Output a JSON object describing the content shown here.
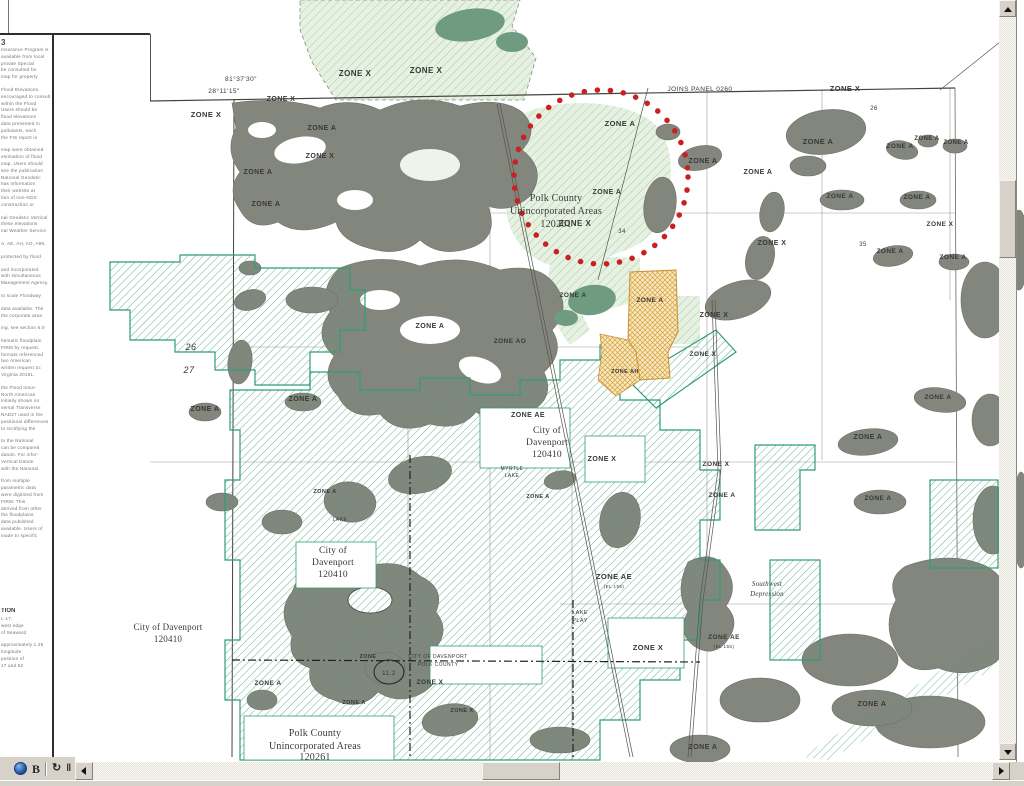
{
  "colors": {
    "map_gray": "#83867c",
    "map_gray_right": "#8b8e85",
    "hatch_green": "#3f9e78",
    "city_boundary_green": "#2f9e77",
    "light_green_fill": "#e2eedd",
    "light_hatch": "#9cc8a0",
    "dark_green_blob": "#6f9c80",
    "red_annotation": "#c92121",
    "orange_zone_line": "#d8a03a",
    "orange_zone_fill": "#f6e8c2",
    "chrome_gray": "#d6d2ca"
  },
  "toolbar": {
    "icons": [
      {
        "name": "globe-icon",
        "glyph": ""
      },
      {
        "name": "letter-b-icon",
        "glyph": "B"
      },
      {
        "name": "refresh-icon",
        "glyph": "↻"
      },
      {
        "name": "pause-icon",
        "glyph": "‖"
      }
    ]
  },
  "notes_panel": {
    "heading": "3",
    "lines": [
      "Insurance Program is",
      "available from local",
      "private Special",
      "be consulted for",
      "map for property",
      "",
      "Flood Elevations.",
      "encouraged to consult",
      "within the Flood",
      "Users should be",
      "flood elevations",
      "data presented in",
      "pollutants, each",
      "the FIS report in",
      "",
      "map were obtained",
      "estimation of flood",
      "map. Users should",
      "see the publication",
      "National Geodetic",
      "has information",
      "their website at",
      "tion of non-NGS",
      "construction or",
      "",
      "nal Geodetic Vertical",
      "these elevations",
      "nal Weather Service",
      "",
      "A, AE, AH, AO, A99,",
      "",
      "protected by flood",
      "",
      "and incorporated",
      "with simultaneous",
      "Management Agency.",
      "",
      "to scale Floodway",
      "",
      "data available. The",
      "the corporate area",
      "",
      "ing, see section 6.0",
      "",
      "hematic floodplain",
      "FIRM by request.",
      "formats referenced",
      "two American",
      "written request to:",
      "Virginia 20191.",
      "",
      "the Flood Insur-",
      "North American",
      "initially shown on",
      "versal Transverse",
      "NAD27 used in the",
      "positional differences",
      "to rectifying the",
      "",
      "to the National",
      "can be compared",
      "datum. For infor-",
      "Vertical Datum",
      "with the National",
      "",
      "from multiple",
      "parametric data",
      "were digitized from",
      "FIRM. This",
      "derived from other",
      "the floodplains",
      "data published",
      "available. Users of",
      "made to specific"
    ],
    "section2_heading": "TION",
    "section2_lines": [
      "L-17,",
      "west edge",
      "of Seaward",
      "",
      "approximately 1.29",
      "longitude",
      "position of",
      "17 and 52"
    ]
  },
  "map": {
    "labels": [
      {
        "t": "81°37'30\"",
        "x": 241,
        "y": 81,
        "s": 6.5,
        "c": "#4a4a46"
      },
      {
        "t": "28°11'15\"",
        "x": 224,
        "y": 93,
        "s": 6.5,
        "c": "#4a4a46"
      },
      {
        "t": "ZONE X",
        "x": 206,
        "y": 117,
        "s": 7.5,
        "b": 1
      },
      {
        "t": "ZONE X",
        "x": 281,
        "y": 101,
        "s": 7,
        "b": 1
      },
      {
        "t": "ZONE X",
        "x": 355,
        "y": 76,
        "s": 8,
        "b": 1
      },
      {
        "t": "ZONE X",
        "x": 426,
        "y": 73,
        "s": 8,
        "b": 1
      },
      {
        "t": "ZONE A",
        "x": 322,
        "y": 130,
        "s": 7,
        "b": 1
      },
      {
        "t": "ZONE X",
        "x": 320,
        "y": 158,
        "s": 7,
        "b": 1
      },
      {
        "t": "ZONE A",
        "x": 258,
        "y": 174,
        "s": 7,
        "b": 1
      },
      {
        "t": "ZONE A",
        "x": 266,
        "y": 206,
        "s": 7,
        "b": 1
      },
      {
        "t": "JOINS PANEL 0260",
        "x": 700,
        "y": 91,
        "s": 6.5,
        "c": "#4a4a46"
      },
      {
        "t": "ZONE X",
        "x": 845,
        "y": 91,
        "s": 7.5,
        "b": 1
      },
      {
        "t": "26",
        "x": 874,
        "y": 110,
        "s": 6
      },
      {
        "t": "ZONE A",
        "x": 620,
        "y": 126,
        "s": 7.5,
        "b": 1
      },
      {
        "t": "ZONE A",
        "x": 607,
        "y": 194,
        "s": 7,
        "b": 1
      },
      {
        "t": "ZONE X",
        "x": 575,
        "y": 226,
        "s": 8,
        "b": 1
      },
      {
        "t": "Polk County",
        "x": 556,
        "y": 201,
        "s": 10,
        "f": "serif"
      },
      {
        "t": "Unincorporated Areas",
        "x": 556,
        "y": 214,
        "s": 10,
        "f": "serif"
      },
      {
        "t": "120261",
        "x": 556,
        "y": 227,
        "s": 10,
        "f": "serif"
      },
      {
        "t": "34",
        "x": 622,
        "y": 233,
        "s": 6
      },
      {
        "t": "ZONE A",
        "x": 703,
        "y": 163,
        "s": 7,
        "b": 1
      },
      {
        "t": "ZONE A",
        "x": 758,
        "y": 174,
        "s": 7,
        "b": 1
      },
      {
        "t": "ZONE A",
        "x": 818,
        "y": 144,
        "s": 7.5,
        "b": 1
      },
      {
        "t": "ZONE A",
        "x": 900,
        "y": 148,
        "s": 6.5,
        "b": 1
      },
      {
        "t": "ZONE A",
        "x": 927,
        "y": 140,
        "s": 6,
        "b": 1
      },
      {
        "t": "ZONE A",
        "x": 956,
        "y": 144,
        "s": 6,
        "b": 1
      },
      {
        "t": "ZONE A",
        "x": 840,
        "y": 198,
        "s": 6.5,
        "b": 1
      },
      {
        "t": "ZONE A",
        "x": 917,
        "y": 199,
        "s": 6.5,
        "b": 1
      },
      {
        "t": "ZONE X",
        "x": 940,
        "y": 226,
        "s": 6.5,
        "b": 1
      },
      {
        "t": "35",
        "x": 863,
        "y": 246,
        "s": 6
      },
      {
        "t": "ZONE A",
        "x": 890,
        "y": 253,
        "s": 6.5,
        "b": 1
      },
      {
        "t": "ZONE A",
        "x": 953,
        "y": 259,
        "s": 6.5,
        "b": 1
      },
      {
        "t": "ZONE X",
        "x": 772,
        "y": 245,
        "s": 7,
        "b": 1
      },
      {
        "t": "ZONE A",
        "x": 573,
        "y": 297,
        "s": 6.5,
        "b": 1
      },
      {
        "t": "ZONE A",
        "x": 650,
        "y": 302,
        "s": 6.5,
        "b": 1
      },
      {
        "t": "ZONE X",
        "x": 714,
        "y": 317,
        "s": 7,
        "b": 1
      },
      {
        "t": "ZONE X",
        "x": 703,
        "y": 356,
        "s": 6.5,
        "b": 1
      },
      {
        "t": "ZONE AH",
        "x": 625,
        "y": 373,
        "s": 5.5,
        "b": 1
      },
      {
        "t": "ZONE A",
        "x": 430,
        "y": 328,
        "s": 7,
        "b": 1
      },
      {
        "t": "ZONE AO",
        "x": 510,
        "y": 343,
        "s": 6.5,
        "b": 1
      },
      {
        "t": "26",
        "x": 191,
        "y": 350,
        "s": 9,
        "i": 1,
        "c": "#8a887e"
      },
      {
        "t": "27",
        "x": 189,
        "y": 373,
        "s": 9,
        "i": 1,
        "c": "#8a887e"
      },
      {
        "t": "ZONE A",
        "x": 205,
        "y": 411,
        "s": 7,
        "b": 1
      },
      {
        "t": "ZONE A",
        "x": 303,
        "y": 401,
        "s": 7,
        "b": 1
      },
      {
        "t": "ZONE AE",
        "x": 528,
        "y": 417,
        "s": 7,
        "b": 1
      },
      {
        "t": "City of",
        "x": 547,
        "y": 433,
        "s": 9.5,
        "f": "serif"
      },
      {
        "t": "Davenport",
        "x": 547,
        "y": 445,
        "s": 9.5,
        "f": "serif"
      },
      {
        "t": "120410",
        "x": 547,
        "y": 457,
        "s": 9.5,
        "f": "serif"
      },
      {
        "t": "ZONE X",
        "x": 602,
        "y": 461,
        "s": 7,
        "b": 1
      },
      {
        "t": "MYRTLE",
        "x": 512,
        "y": 470,
        "s": 5
      },
      {
        "t": "LAKE",
        "x": 512,
        "y": 477,
        "s": 5
      },
      {
        "t": "ZONE A",
        "x": 538,
        "y": 498,
        "s": 5.5,
        "b": 1
      },
      {
        "t": "ZONE X",
        "x": 716,
        "y": 466,
        "s": 6.5,
        "b": 1
      },
      {
        "t": "ZONE A",
        "x": 722,
        "y": 497,
        "s": 6.5,
        "b": 1
      },
      {
        "t": "ZONE A",
        "x": 868,
        "y": 439,
        "s": 7,
        "b": 1
      },
      {
        "t": "ZONE A",
        "x": 878,
        "y": 500,
        "s": 6.5,
        "b": 1
      },
      {
        "t": "ZONE A",
        "x": 938,
        "y": 399,
        "s": 6.5,
        "b": 1
      },
      {
        "t": "ZONE A",
        "x": 325,
        "y": 493,
        "s": 5.5,
        "b": 1
      },
      {
        "t": "LAKE",
        "x": 340,
        "y": 521,
        "s": 5
      },
      {
        "t": "City of",
        "x": 333,
        "y": 553,
        "s": 9.5,
        "f": "serif"
      },
      {
        "t": "Davenport",
        "x": 333,
        "y": 565,
        "s": 9.5,
        "f": "serif"
      },
      {
        "t": "120410",
        "x": 333,
        "y": 577,
        "s": 9.5,
        "f": "serif"
      },
      {
        "t": "ZONE AE",
        "x": 614,
        "y": 579,
        "s": 7.5,
        "b": 1
      },
      {
        "t": "(EL 159)",
        "x": 614,
        "y": 588,
        "s": 4.5
      },
      {
        "t": "LAKE",
        "x": 580,
        "y": 614,
        "s": 5.5
      },
      {
        "t": "PLAY",
        "x": 580,
        "y": 622,
        "s": 5.5
      },
      {
        "t": "Southwest",
        "x": 767,
        "y": 586,
        "s": 7,
        "f": "serif",
        "i": 1
      },
      {
        "t": "Depression",
        "x": 767,
        "y": 596,
        "s": 7,
        "f": "serif",
        "i": 1
      },
      {
        "t": "ZONE X",
        "x": 648,
        "y": 650,
        "s": 7.5,
        "b": 1
      },
      {
        "t": "ZONE AE",
        "x": 724,
        "y": 639,
        "s": 6.5,
        "b": 1
      },
      {
        "t": "(EL 155)",
        "x": 724,
        "y": 648,
        "s": 4.5
      },
      {
        "t": "City of Davenport",
        "x": 168,
        "y": 630,
        "s": 9,
        "f": "serif"
      },
      {
        "t": "120410",
        "x": 168,
        "y": 642,
        "s": 9,
        "f": "serif"
      },
      {
        "t": "CITY OF DAVENPORT",
        "x": 438,
        "y": 658,
        "s": 5
      },
      {
        "t": "POLK COUNTY",
        "x": 438,
        "y": 666,
        "s": 5
      },
      {
        "t": "ZONE",
        "x": 368,
        "y": 658,
        "s": 5.5,
        "b": 1
      },
      {
        "t": "11.2",
        "x": 389,
        "y": 675,
        "s": 6.5,
        "c": "#111111"
      },
      {
        "t": "ZONE A",
        "x": 268,
        "y": 685,
        "s": 6.5,
        "b": 1
      },
      {
        "t": "ZONE A",
        "x": 354,
        "y": 704,
        "s": 5.5,
        "b": 1
      },
      {
        "t": "ZONE X",
        "x": 430,
        "y": 684,
        "s": 6.5,
        "b": 1
      },
      {
        "t": "ZONE X",
        "x": 462,
        "y": 712,
        "s": 5.5,
        "b": 1
      },
      {
        "t": "Polk County",
        "x": 315,
        "y": 736,
        "s": 10,
        "f": "serif"
      },
      {
        "t": "Unincorporated Areas",
        "x": 315,
        "y": 749,
        "s": 10,
        "f": "serif"
      },
      {
        "t": "120261",
        "x": 315,
        "y": 760,
        "s": 10,
        "f": "serif"
      },
      {
        "t": "ZONE A",
        "x": 703,
        "y": 749,
        "s": 7,
        "b": 1
      },
      {
        "t": "ZONE A",
        "x": 872,
        "y": 706,
        "s": 7,
        "b": 1
      }
    ]
  }
}
